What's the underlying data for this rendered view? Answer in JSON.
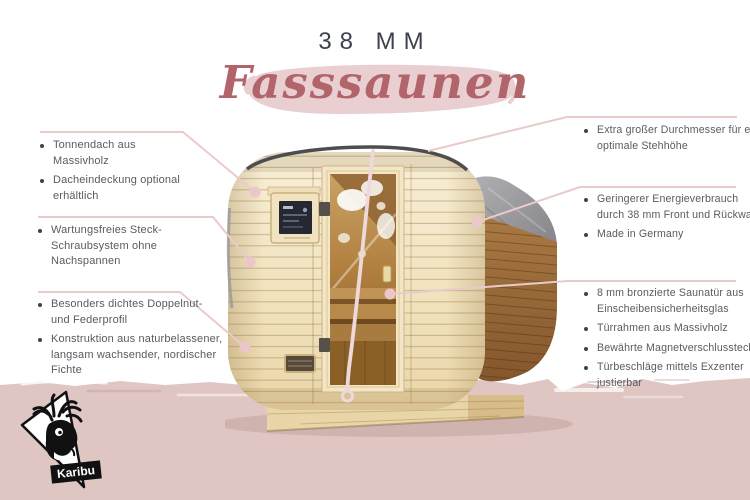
{
  "header": {
    "thickness_label": "38 MM",
    "product_label": "Fasssaunen"
  },
  "annotations": {
    "left": [
      {
        "bullets": [
          {
            "lines": [
              "Tonnendach aus",
              "Massivholz"
            ]
          },
          {
            "lines": [
              "Dacheindeckung optional",
              "erhältlich"
            ]
          }
        ]
      },
      {
        "bullets": [
          {
            "lines": [
              "Wartungsfreies Steck-",
              "Schraubsystem ohne",
              "Nachspannen"
            ]
          }
        ]
      },
      {
        "bullets": [
          {
            "lines": [
              "Besonders dichtes Doppelnut-",
              "und Federprofil"
            ]
          },
          {
            "lines": [
              "Konstruktion aus naturbelassener,",
              "langsam wachsender, nordischer",
              "Fichte"
            ]
          }
        ]
      }
    ],
    "right": [
      {
        "bullets": [
          {
            "lines": [
              "Extra großer Durchmesser für eine",
              "optimale Stehhöhe"
            ]
          }
        ]
      },
      {
        "bullets": [
          {
            "lines": [
              "Geringerer Energieverbrauch",
              "durch 38 mm Front und Rückwand"
            ]
          },
          {
            "lines": [
              "Made in Germany"
            ]
          }
        ]
      },
      {
        "bullets": [
          {
            "lines": [
              "8 mm bronzierte Saunatür aus",
              "Einscheibensicherheitsglas"
            ]
          },
          {
            "lines": [
              "Türrahmen aus Massivholz"
            ]
          },
          {
            "lines": [
              "Bewährte Magnetverschlusstechnik"
            ]
          },
          {
            "lines": [
              "Türbeschläge mittels Exzenter",
              "justierbar"
            ]
          }
        ]
      }
    ]
  },
  "logo": {
    "brand": "Karibu",
    "icon": "deer-head-in-triangle"
  },
  "colors": {
    "background": "#ffffff",
    "title_text": "#3c414d",
    "body_text": "#585b62",
    "script_text": "#b2646b",
    "script_brush": "#e9cfd1",
    "callout_line": "#e9cbc9",
    "callout_dot": "#ebc7ca",
    "bottom_band": "#dfc6c3",
    "sauna_pine": "#f2e3c1",
    "sauna_side_wood": "#9a6a3e",
    "roof_tarp": "#919194"
  }
}
